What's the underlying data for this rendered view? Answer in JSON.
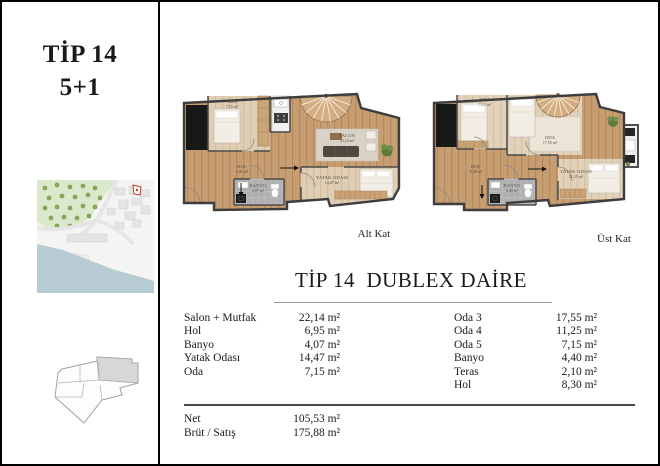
{
  "sidebar": {
    "unit_type": "TİP 14",
    "unit_config": "5+1"
  },
  "plans": {
    "alt": {
      "caption": "Alt Kat",
      "rooms": {
        "oda": {
          "name": "ODA",
          "area": "7,15 m²"
        },
        "salon": {
          "name": "SALON",
          "area": "22,14 m²"
        },
        "hol": {
          "name": "HOL",
          "area": "6,95 m²"
        },
        "banyo": {
          "name": "BANYO",
          "area": "4,07 m²"
        },
        "yatak": {
          "name": "YATAK ODASI",
          "area": "14,47 m²"
        }
      }
    },
    "ust": {
      "caption": "Üst Kat",
      "rooms": {
        "oda_small": {
          "name": "ODA",
          "area": "7,15 m²"
        },
        "oda_large": {
          "name": "ODA",
          "area": "17,55 m²"
        },
        "hol": {
          "name": "HOL",
          "area": "8,30 m²"
        },
        "banyo": {
          "name": "BANYO",
          "area": "4,40 m²"
        },
        "yatak": {
          "name": "YATAK ODASI",
          "area": "11,25 m²"
        }
      }
    }
  },
  "details": {
    "title": "TİP 14  DUBLEX DAİRE",
    "left_rows": [
      {
        "label": "Salon + Mutfak",
        "value": "22,14 m²"
      },
      {
        "label": "Hol",
        "value": "6,95 m²"
      },
      {
        "label": "Banyo",
        "value": "4,07 m²"
      },
      {
        "label": "Yatak Odası",
        "value": "14,47 m²"
      },
      {
        "label": "Oda",
        "value": "7,15 m²"
      }
    ],
    "right_rows": [
      {
        "label": "Oda 3",
        "value": "17,55 m²"
      },
      {
        "label": "Oda 4",
        "value": "11,25 m²"
      },
      {
        "label": "Oda 5",
        "value": "7,15 m²"
      },
      {
        "label": "Banyo",
        "value": "4,40 m²"
      },
      {
        "label": "Teras",
        "value": "2,10 m²"
      },
      {
        "label": "Hol",
        "value": "8,30 m²"
      }
    ],
    "summary_rows": [
      {
        "label": "Net",
        "value": "105,53 m²"
      },
      {
        "label": "Brüt / Satış",
        "value": "175,88 m²"
      }
    ]
  },
  "colors": {
    "wood": "#c79d72",
    "wood_light": "#dfcdb4",
    "tile_gray": "#b0b0b0",
    "shaft_black": "#181818",
    "park_green": "#dce8cb",
    "tree_green": "#86a65c",
    "water_blue": "#b7ccd2",
    "marker_red": "#c0392b"
  }
}
